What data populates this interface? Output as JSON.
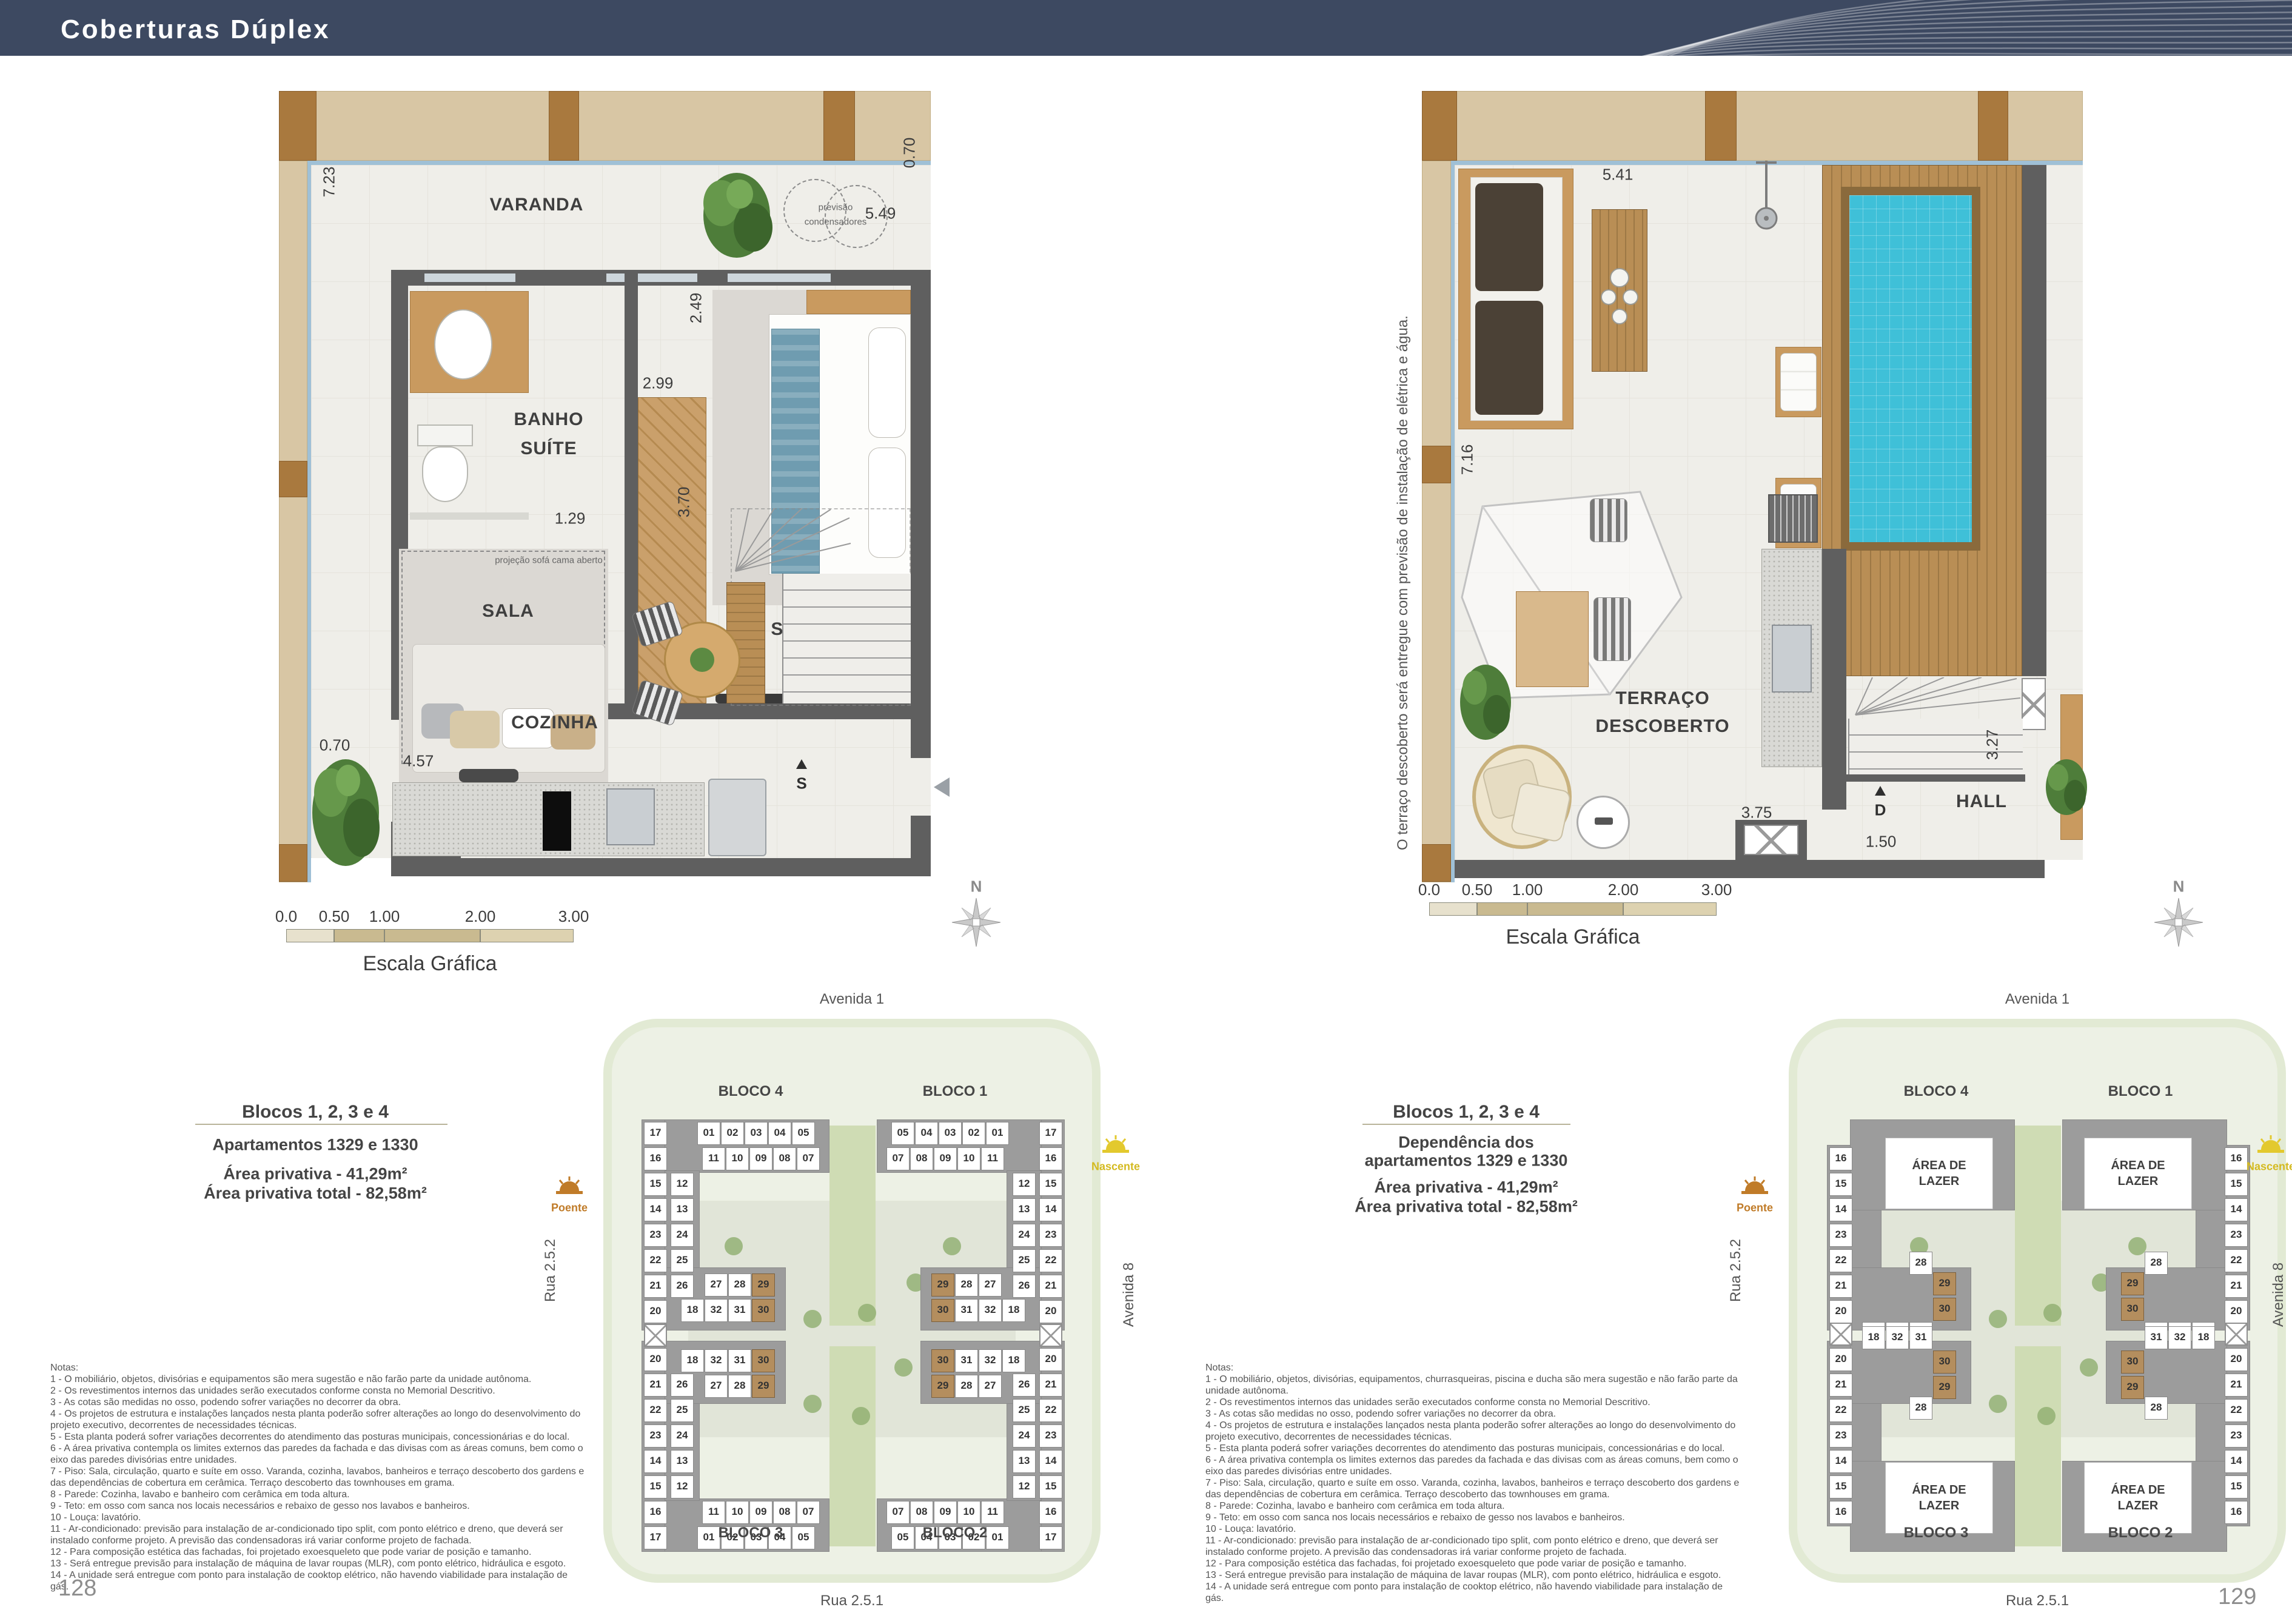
{
  "header": {
    "title": "Coberturas Dúplex"
  },
  "scale_bar": {
    "ticks": [
      "0.0",
      "0.50",
      "1.00",
      "2.00",
      "3.00"
    ],
    "label": "Escala Gráfica"
  },
  "compass": {
    "label": "N"
  },
  "left_page": {
    "page_number": "128",
    "plan": {
      "varanda": "VARANDA",
      "banho1": "BANHO",
      "banho2": "SUÍTE",
      "suite": "SUÍTE",
      "sala": "SALA",
      "cozinha": "COZINHA",
      "cond1": "previsão",
      "cond2": "condensadores",
      "projecao": "projeção sofá cama aberto",
      "stair_letter": "S",
      "d_left": "7.23",
      "d_tr_v": "0.70",
      "d_tr_h": "5.49",
      "d_249": "2.49",
      "d_299": "2.99",
      "d_129": "1.29",
      "d_232": "2.32",
      "d_370": "3.70",
      "d_070b": "0.70",
      "d_457": "4.57"
    },
    "info": {
      "title": "Blocos 1, 2, 3 e 4",
      "subtitle": "Apartamentos 1329 e 1330",
      "area1": "Área privativa - 41,29m²",
      "area2": "Área privativa total - 82,58m²"
    },
    "notes": {
      "title": "Notas:",
      "lines": [
        "1 - O mobiliário, objetos, divisórias e equipamentos são mera sugestão e não farão parte da unidade autônoma.",
        "2 - Os revestimentos internos das unidades serão executados conforme consta no Memorial Descritivo.",
        "3 - As cotas são medidas no osso, podendo sofrer variações no decorrer da obra.",
        "4 - Os projetos de estrutura e instalações lançados nesta planta poderão sofrer alterações ao longo do desenvolvimento do projeto executivo, decorrentes de necessidades técnicas.",
        "5 - Esta planta poderá sofrer variações decorrentes do atendimento das posturas municipais, concessionárias e do local.",
        "6 - A área privativa contempla os limites externos das paredes da fachada e das divisas com as áreas comuns, bem como o eixo das paredes divisórias entre unidades.",
        "7 - Piso: Sala, circulação, quarto e suíte em osso. Varanda, cozinha, lavabos, banheiros e terraço descoberto dos gardens e das dependências de cobertura em cerâmica. Terraço descoberto das townhouses em grama.",
        "8 - Parede: Cozinha, lavabo e banheiro com cerâmica em toda altura.",
        "9 - Teto: em osso com sanca nos locais necessários e rebaixo de gesso nos lavabos e banheiros.",
        "10 - Louça: lavatório.",
        "11 - Ar-condicionado: previsão para instalação de ar-condicionado tipo split, com ponto elétrico e dreno, que deverá ser instalado conforme projeto. A previsão das condensadoras irá variar conforme projeto de fachada.",
        "12 - Para composição estética das fachadas, foi projetado exoesqueleto que pode variar de posição e tamanho.",
        "13 - Será entregue previsão para instalação de máquina de lavar roupas (MLR), com ponto elétrico, hidráulica e esgoto.",
        "14 - A unidade será entregue com ponto para instalação de cooktop elétrico, não havendo viabilidade para instalação de gás."
      ]
    }
  },
  "right_page": {
    "page_number": "129",
    "plan": {
      "terraco1": "TERRAÇO",
      "terraco2": "DESCOBERTO",
      "hall": "HALL",
      "stair_letter": "D",
      "side_note": "O terraço descoberto será entregue com previsão de instalação de elétrica e água.",
      "d_top": "5.41",
      "d_left": "7.16",
      "d_327": "3.27",
      "d_375": "3.75",
      "d_150": "1.50"
    },
    "info": {
      "title": "Blocos 1, 2, 3 e 4",
      "subtitle1": "Dependência dos",
      "subtitle2": "apartamentos 1329 e 1330",
      "area1": "Área privativa - 41,29m²",
      "area2": "Área privativa total - 82,58m²"
    },
    "notes": {
      "title": "Notas:",
      "lines": [
        "1 - O mobiliário, objetos, divisórias, equipamentos, churrasqueiras, piscina e ducha são mera sugestão e não farão parte da unidade autônoma.",
        "2 - Os revestimentos internos das unidades serão executados conforme consta no Memorial Descritivo.",
        "3 - As cotas são medidas no osso, podendo sofrer variações no decorrer da obra.",
        "4 - Os projetos de estrutura e instalações lançados nesta planta poderão sofrer alterações ao longo do desenvolvimento do projeto executivo, decorrentes de necessidades técnicas.",
        "5 - Esta planta poderá sofrer variações decorrentes do atendimento das posturas municipais, concessionárias e do local.",
        "6 - A área privativa contempla os limites externos das paredes da fachada e das divisas com as áreas comuns, bem como o eixo das paredes divisórias entre unidades.",
        "7 - Piso: Sala, circulação, quarto e suíte em osso. Varanda, cozinha, lavabos, banheiros e terraço descoberto dos gardens e das dependências de cobertura em cerâmica. Terraço descoberto das townhouses em grama.",
        "8 - Parede: Cozinha, lavabo e banheiro com cerâmica em toda altura.",
        "9 - Teto: em osso com sanca nos locais necessários e rebaixo de gesso nos lavabos e banheiros.",
        "10 - Louça: lavatório.",
        "11 - Ar-condicionado: previsão para instalação de ar-condicionado tipo split, com ponto elétrico e dreno, que deverá ser instalado conforme projeto. A previsão das condensadoras irá variar conforme projeto de fachada.",
        "12 - Para composição estética das fachadas, foi projetado exoesqueleto que pode variar de posição e tamanho.",
        "13 - Será entregue previsão para instalação de máquina de lavar roupas (MLR), com ponto elétrico, hidráulica e esgoto.",
        "14 - A unidade será entregue com ponto para instalação de cooktop elétrico, não havendo viabilidade para instalação de gás."
      ]
    }
  },
  "site_plan": {
    "streets": {
      "top": "Avenida 1",
      "bottom": "Rua 2.5.1",
      "left": "Rua 2.5.2",
      "right": "Avenida 8"
    },
    "suns": {
      "west": "Poente",
      "east": "Nascente",
      "west_color": "#c07b28",
      "east_color": "#e3c92e"
    },
    "blocks": {
      "tl": "BLOCO 4",
      "tr": "BLOCO 1",
      "bl": "BLOCO 3",
      "br": "BLOCO 2"
    },
    "lower": {
      "outer_col": [
        "17",
        "16",
        "15",
        "14",
        "23",
        "22",
        "21",
        "20"
      ],
      "inner_col": [
        "12",
        "13",
        "24",
        "25",
        "26"
      ],
      "row_top": [
        "01",
        "02",
        "03",
        "04",
        "05"
      ],
      "row_mid": [
        "11",
        "10",
        "09",
        "08",
        "07"
      ],
      "row_27": [
        "27",
        "28",
        "29"
      ],
      "row_bot": [
        "18",
        "32",
        "31",
        "30"
      ],
      "highlight": [
        "29",
        "30"
      ]
    },
    "upper": {
      "outer_col": [
        "16",
        "15",
        "14",
        "23",
        "22",
        "21",
        "20"
      ],
      "lazer1": "ÁREA DE",
      "lazer2": "LAZER",
      "cell_28": "28",
      "cell_29": "29",
      "cell_30": "30",
      "row_bot": [
        "18",
        "32",
        "31"
      ],
      "highlight": [
        "29",
        "30"
      ]
    }
  },
  "colors": {
    "header": "#3d4961",
    "pool": "#3fc0d8",
    "highlight_unit": "#b48e5e"
  }
}
